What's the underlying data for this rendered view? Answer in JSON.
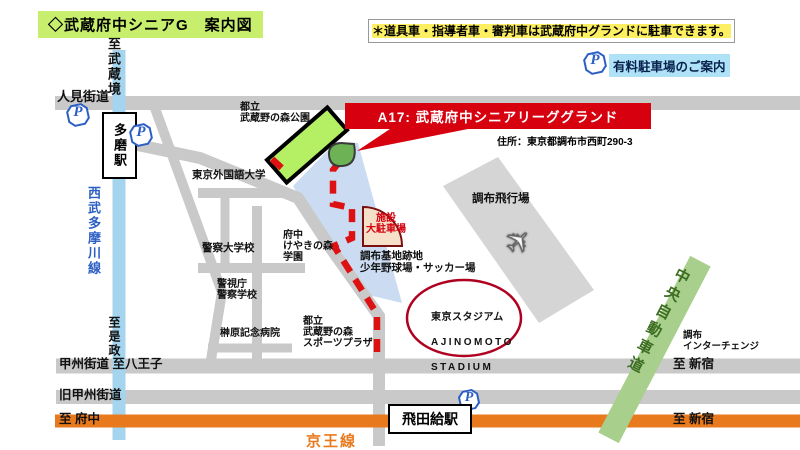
{
  "header": {
    "title": "◇武蔵府中シニアG　案内図",
    "notice": "＊道具車・指導者車・審判車は武蔵府中グランドに駐車できます。",
    "paid_parking_label": "有料駐車場のご案内"
  },
  "banner": {
    "label": "A17: 武蔵府中シニアリーググランド",
    "address": "住所：東京都調布市西町290-3"
  },
  "stations": {
    "tama": "多磨駅",
    "tobitakyu": "飛田給駅"
  },
  "railways": {
    "seibu_tamagawa": "西武多摩川線",
    "keio": "京王線"
  },
  "roads": {
    "hitomi_kaido": "人見街道",
    "koshu_kaido": "甲州街道 至八王子",
    "kyu_koshu_kaido": "旧甲州街道",
    "chuo_expressway": "中央自動車道"
  },
  "directions": {
    "to_musashisakai": "至武蔵境",
    "to_koremasa": "至是政",
    "to_fuchu": "至 府中",
    "to_shinjuku_upper": "至 新宿",
    "to_shinjuku_lower": "至 新宿",
    "chofu_interchange": "調布\nインターチェンジ"
  },
  "places": {
    "musashino_park": "都立\n武蔵野の森公園",
    "tokyo_univ_foreign_studies": "東京外国語大学",
    "police_university": "警察大学校",
    "keyakinomori_gakuen": "府中\nけやきの森\n学園",
    "mpd_police_school": "警視庁\n警察学校",
    "sakakibara_hospital": "榊原記念病院",
    "sports_plaza": "都立\n武蔵野の森\nスポーツプラザ",
    "chofu_base_site": "調布基地跡地\n少年野球場・サッカー場",
    "chofu_airfield": "調布飛行場",
    "facility_parking": "施設\n大駐車場",
    "stadium_line1": "東京スタジアム",
    "stadium_line2": "AJINOMOTO",
    "stadium_line3": "STADIUM"
  },
  "icons": {
    "parking": "P",
    "airplane": "✈"
  },
  "colors": {
    "accent_red": "#d6000f",
    "route_red": "#dd1111",
    "park_green": "#b5ef63",
    "marker_green": "#6db356",
    "zone_blue": "#cbdcf2",
    "airfield_gray": "#d5d5d5",
    "road_gray": "#c9c9c9",
    "rail_blue": "#a5d5ee",
    "keio_orange": "#e8791d",
    "expressway_green": "#a9cf8d",
    "fan_fill": "#f7e0c9",
    "stadium_ring": "#b00020"
  }
}
